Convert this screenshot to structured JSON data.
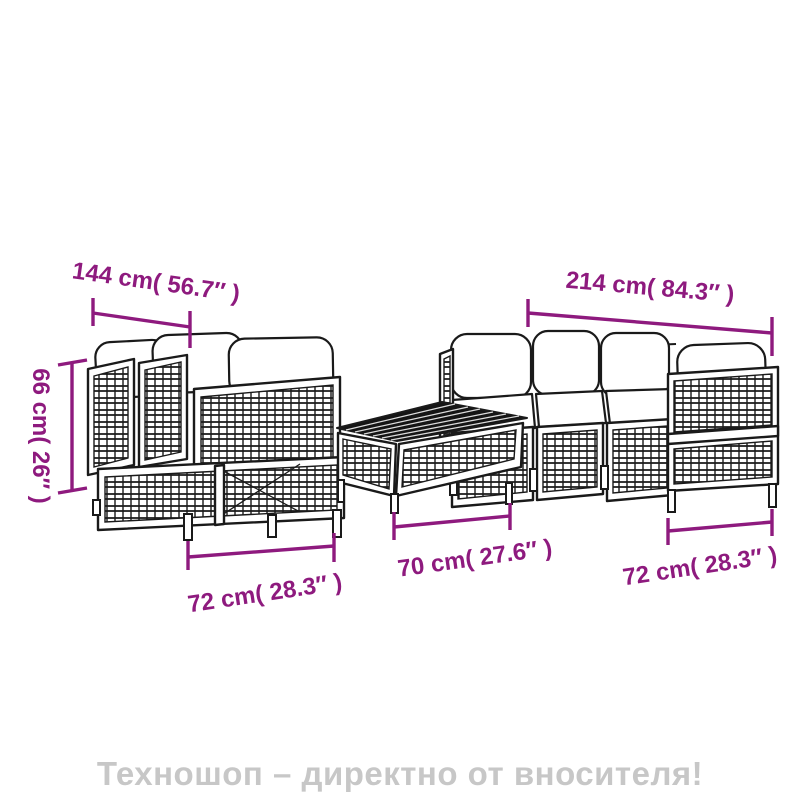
{
  "diagram_type": "furniture-dimension-line-drawing",
  "dimensions": {
    "total_width_left": {
      "label": "144 cm( 56.7″ )",
      "cm": 144,
      "inches": 56.7
    },
    "total_width_right": {
      "label": "214 cm( 84.3″ )",
      "cm": 214,
      "inches": 84.3
    },
    "height": {
      "label": "66 cm( 26″ )",
      "cm": 66,
      "inches": 26
    },
    "depth_left_module": {
      "label": "72 cm( 28.3″ )",
      "cm": 72,
      "inches": 28.3
    },
    "table_width": {
      "label": "70 cm( 27.6″ )",
      "cm": 70,
      "inches": 27.6
    },
    "depth_right_module": {
      "label": "72 cm( 28.3″ )",
      "cm": 72,
      "inches": 28.3
    }
  },
  "watermark": {
    "text": "Техношоп – директно от вносителя!"
  },
  "illustration": {
    "pieces": [
      "corner-sofa-pair",
      "coffee-table",
      "three-module-sofa-with-armrest"
    ],
    "style": "black outline wicker line art with white cushions"
  },
  "colors": {
    "dimension": "#8e1a7e",
    "line_art": "#1a1a1a",
    "watermark": "#c7c7c7",
    "table_top": "#151515",
    "background": "#ffffff"
  }
}
